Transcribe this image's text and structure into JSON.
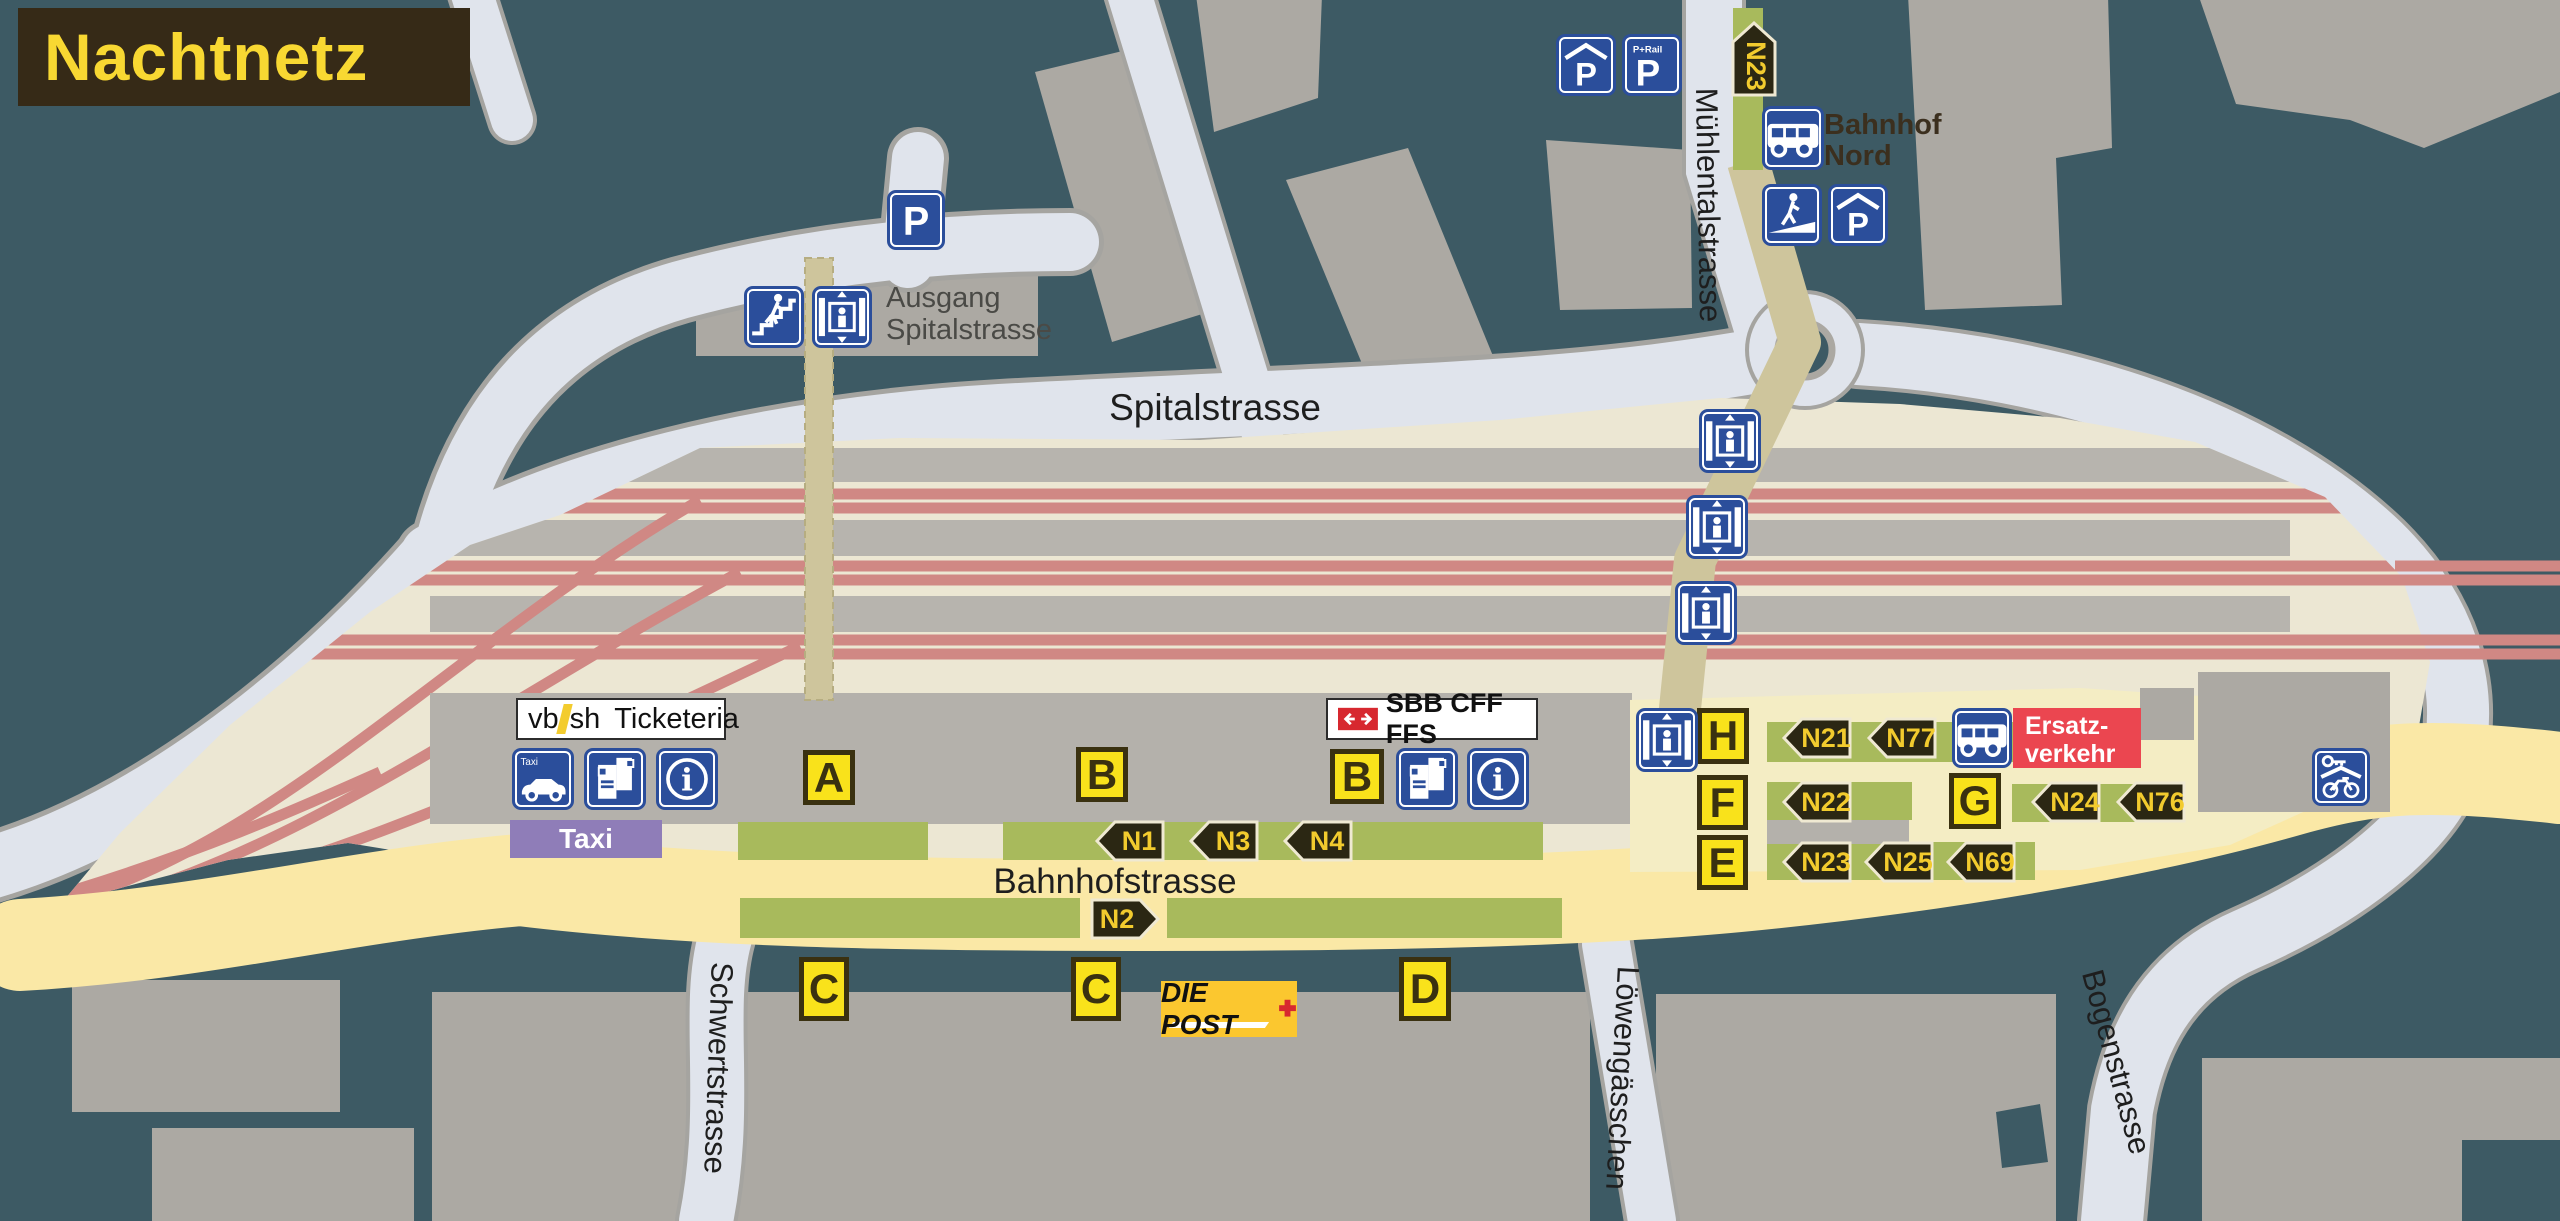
{
  "title": "Nachtnetz",
  "streets": {
    "spitalstrasse": "Spitalstrasse",
    "muehlentalstrasse": "Mühlentalstrasse",
    "bahnhofstrasse": "Bahnhofstrasse",
    "schwertstrasse": "Schwertstrasse",
    "loewengaesschen": "Löwengässchen",
    "bogenstrasse": "Bogenstrasse"
  },
  "signs": {
    "ausgang": {
      "line1": "Ausgang",
      "line2": "Spitalstrasse"
    },
    "bahnhof_nord": {
      "line1": "Bahnhof",
      "line2": "Nord"
    },
    "ticketeria": {
      "vb": "vb",
      "sh": "sh",
      "label": "Ticketeria"
    },
    "sbb": {
      "label": "SBB CFF FFS"
    },
    "ersatzverkehr": {
      "line1": "Ersatz-",
      "line2": "verkehr"
    },
    "taxi_stand": "Taxi",
    "post": "DIE POST",
    "parking": "P",
    "p_rail": "P+Rail",
    "taxi_icon_label": "Taxi"
  },
  "stops": {
    "a": "A",
    "b1": "B",
    "b2": "B",
    "c1": "C",
    "c2": "C",
    "d": "D",
    "e": "E",
    "f": "F",
    "g": "G",
    "h": "H"
  },
  "lines": {
    "n1": "N1",
    "n2": "N2",
    "n3": "N3",
    "n4": "N4",
    "n21": "N21",
    "n22": "N22",
    "n23": "N23",
    "n23_nord": "N23",
    "n24": "N24",
    "n25": "N25",
    "n69": "N69",
    "n76": "N76",
    "n77": "N77"
  },
  "icons": {
    "info": "i"
  },
  "colors": {
    "background": "#3D5A64",
    "building": "#ACA9A3",
    "road": "#E0E4EC",
    "station_area": "#ECE7D3",
    "track": "#D08884",
    "platform": "#B7B4AE",
    "bus_platform": "#A8BA5C",
    "stop_fill": "#F9E21B",
    "stop_border": "#3A3110",
    "badge_bg": "#2B2713",
    "badge_text": "#F2CB2E",
    "icon_blue": "#2B4E9B",
    "title_bg": "#362A17",
    "title_text": "#F8D832",
    "ersatz_red": "#EB4650",
    "taxi_purple": "#8F7DB8",
    "post_yellow": "#FBC72F",
    "sbb_red": "#D7282F",
    "street_yellow": "#FAE8A6",
    "path_khaki": "#CEC59C"
  }
}
